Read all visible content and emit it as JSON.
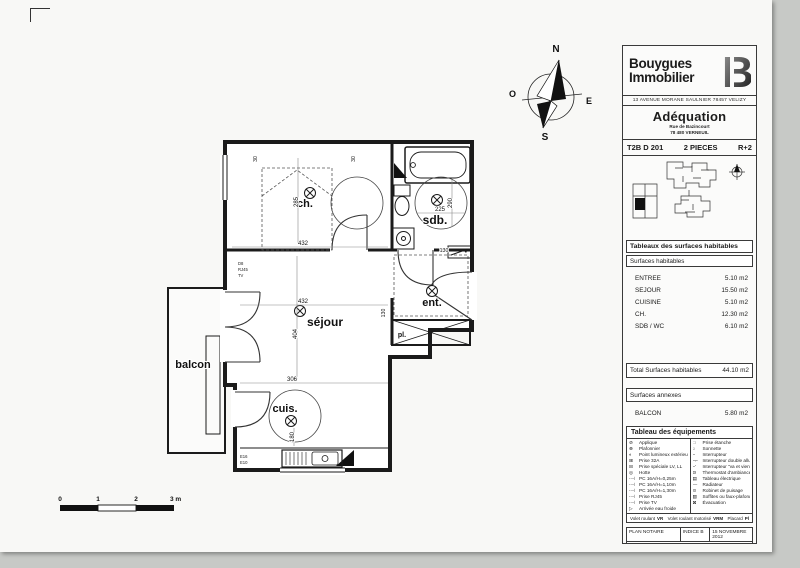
{
  "plan": {
    "rooms": {
      "ch": "ch.",
      "sdb": "sdb.",
      "sejour": "séjour",
      "ent": "ent.",
      "pl": "pl.",
      "cuis": "cuis.",
      "balcon": "balcon"
    },
    "dims": {
      "ch_h": "285",
      "ch_w": "432",
      "sejour_w": "432",
      "sejour_h": "404",
      "sejour_b": "306",
      "cuis_h": "180",
      "sdb_w": "225",
      "sdb_h": "290",
      "hall_1": "130",
      "hall_2": "130",
      "wall_1": "30",
      "wall_2": "30"
    },
    "outlets": {
      "left_stack": [
        "D8",
        "RJ45",
        "TV"
      ],
      "kitchen_stack": [
        "E16",
        "E10"
      ]
    },
    "compass": {
      "n": "N",
      "s": "S",
      "e": "E",
      "o": "O"
    },
    "scale_bar": {
      "t0": "0",
      "t1": "1",
      "t2": "2",
      "t3": "3 m"
    }
  },
  "title_block": {
    "brand": {
      "name_line1": "Bouygues",
      "name_line2": "Immobilier",
      "logo_letter": "B",
      "address": "13 AVENUE MORANE SAULNIER 78457 VELIZY"
    },
    "project": {
      "name": "Adéquation",
      "address_line1": "Rue de Bazincourt",
      "address_line2": "78 480 VERNEUIL"
    },
    "unit": {
      "ref": "T2B D 201",
      "rooms": "2 PIECES",
      "floor": "R+2"
    },
    "surfaces": {
      "title": "Tableaux des surfaces habitables",
      "subtitle": "Surfaces habitables",
      "rows": [
        {
          "label": "ENTREE",
          "value": "5.10 m2"
        },
        {
          "label": "SEJOUR",
          "value": "15.50 m2"
        },
        {
          "label": "CUISINE",
          "value": "5.10 m2"
        },
        {
          "label": "CH.",
          "value": "12.30 m2"
        },
        {
          "label": "SDB / WC",
          "value": "6.10 m2"
        }
      ],
      "total_label": "Total Surfaces habitables",
      "total_value": "44.10 m2",
      "annex_title": "Surfaces annexes",
      "annex_rows": [
        {
          "label": "BALCON",
          "value": "5.80 m2"
        }
      ]
    },
    "equipment": {
      "title": "Tableau des équipements",
      "left_items": [
        {
          "glyph": "⊘",
          "label": "Applique"
        },
        {
          "glyph": "⊗",
          "label": "Plafonnier"
        },
        {
          "glyph": "◐",
          "label": "Point lumineux extérieur"
        },
        {
          "glyph": "⊞",
          "label": "Prise 32A"
        },
        {
          "glyph": "⊟",
          "label": "Prise spéciale LV, LL"
        },
        {
          "glyph": "◎",
          "label": "Hotte"
        },
        {
          "glyph": "-⊣",
          "label": "PC 16A/H=0,25m"
        },
        {
          "glyph": "-⊣",
          "label": "PC 16A/H=1,10m"
        },
        {
          "glyph": "-⊣",
          "label": "PC 16A/H=1,30m"
        },
        {
          "glyph": "-⊣",
          "label": "Prise RJ45"
        },
        {
          "glyph": "-⊣",
          "label": "Prise TV"
        },
        {
          "glyph": "▷",
          "label": "Arrivée eau froide"
        }
      ],
      "right_items": [
        {
          "glyph": "□",
          "label": "Prise étanche"
        },
        {
          "glyph": "○",
          "label": "Sonnette"
        },
        {
          "glyph": "⌐",
          "label": "Interrupteur"
        },
        {
          "glyph": "⌐⌐",
          "label": "Interrupteur double allumage"
        },
        {
          "glyph": "⌐'",
          "label": "Interrupteur \"va et vient\""
        },
        {
          "glyph": "Θ",
          "label": "Thermostat d'ambiance"
        },
        {
          "glyph": "▤",
          "label": "Tableau électrique"
        },
        {
          "glyph": "—",
          "label": "Radiateur"
        },
        {
          "glyph": "⊙",
          "label": "Robinet de puisage"
        },
        {
          "glyph": "▨",
          "label": "Soffites ou faux-plafonds"
        },
        {
          "glyph": "⊠",
          "label": "Évacuation"
        }
      ],
      "abbreviations": [
        {
          "label": "Volet roulant",
          "abbr": "VR"
        },
        {
          "label": "Volet roulant motorisé",
          "abbr": "VRM"
        },
        {
          "label": "Placard",
          "abbr": "Pl"
        }
      ]
    },
    "footer": {
      "doc_type": "PLAN NOTAIRE",
      "indice": "INDICE B",
      "date": "15 NOVEMBRE 2012",
      "nota": "NOTA: En fonction des nécessités techniques de la réalisation, des modifications sont susceptibles d'être apportées à ce plan. Les soffites, faux-plafonds et gaines sont susceptibles d'évoluer en situation, en nombre et dimension. Les canalisations, retombées, regards ne sont pas figurés. Les surfaces indiquées sont approximatives."
    }
  }
}
